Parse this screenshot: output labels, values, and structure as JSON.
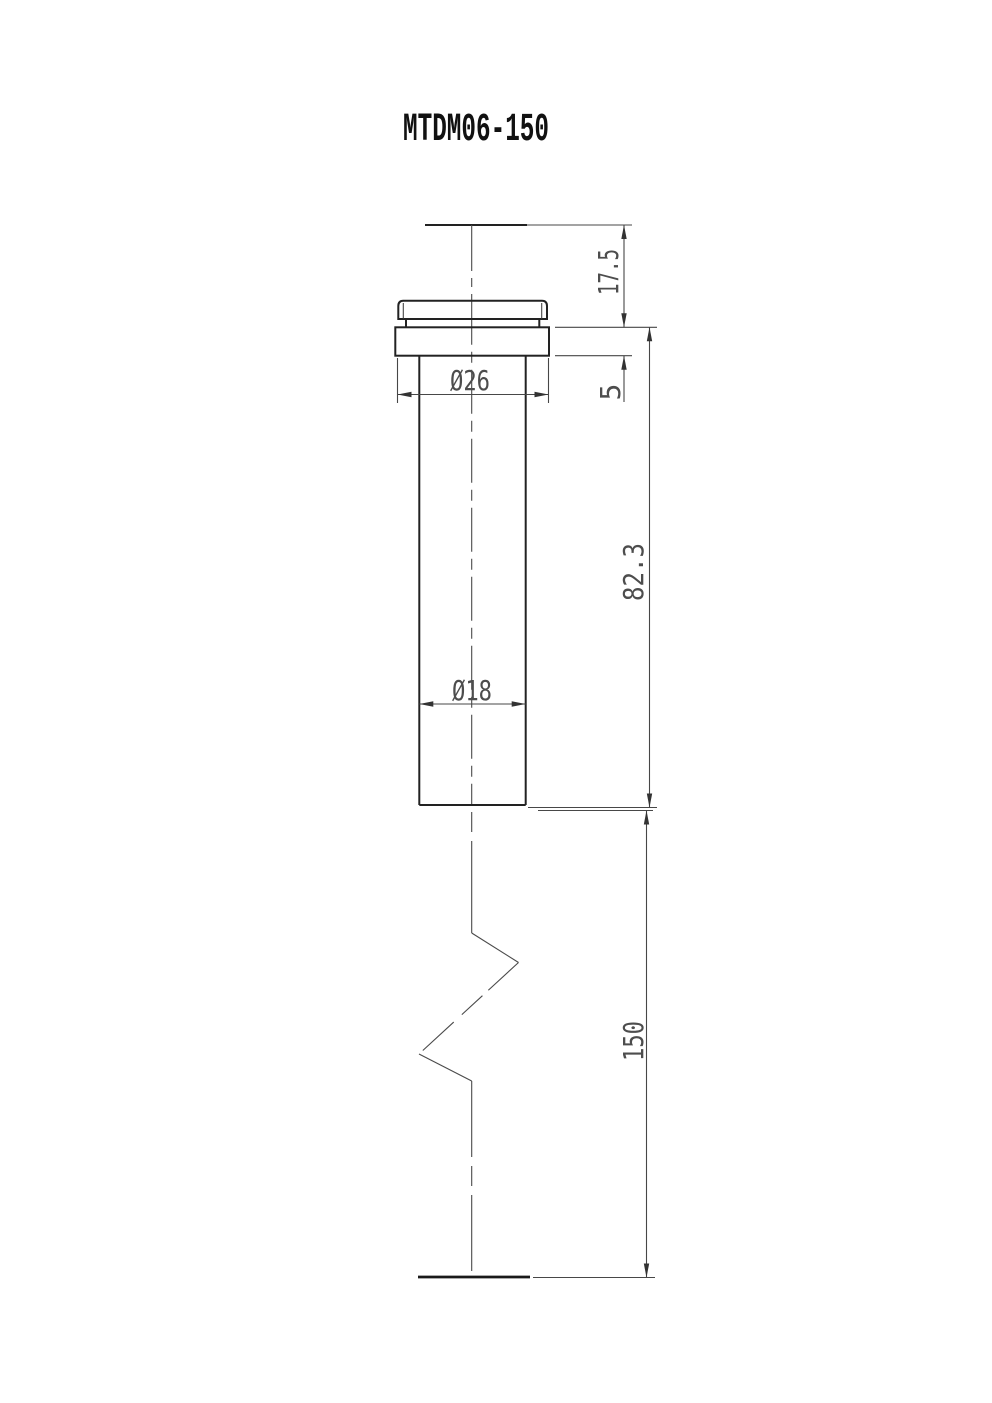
{
  "title": "MTDM06-150",
  "dimensions": {
    "head_height": "17.5",
    "flange_thickness": "5",
    "body_length": "82.3",
    "overall_length": "150",
    "flange_diameter": "Ø26",
    "shaft_diameter": "Ø18"
  },
  "colors": {
    "object_line": "#222222",
    "thin_line": "#474747",
    "centerline": "#4a4a4a",
    "dim_text": "#4d4d4d",
    "title_text": "#111111",
    "background": "#ffffff"
  }
}
